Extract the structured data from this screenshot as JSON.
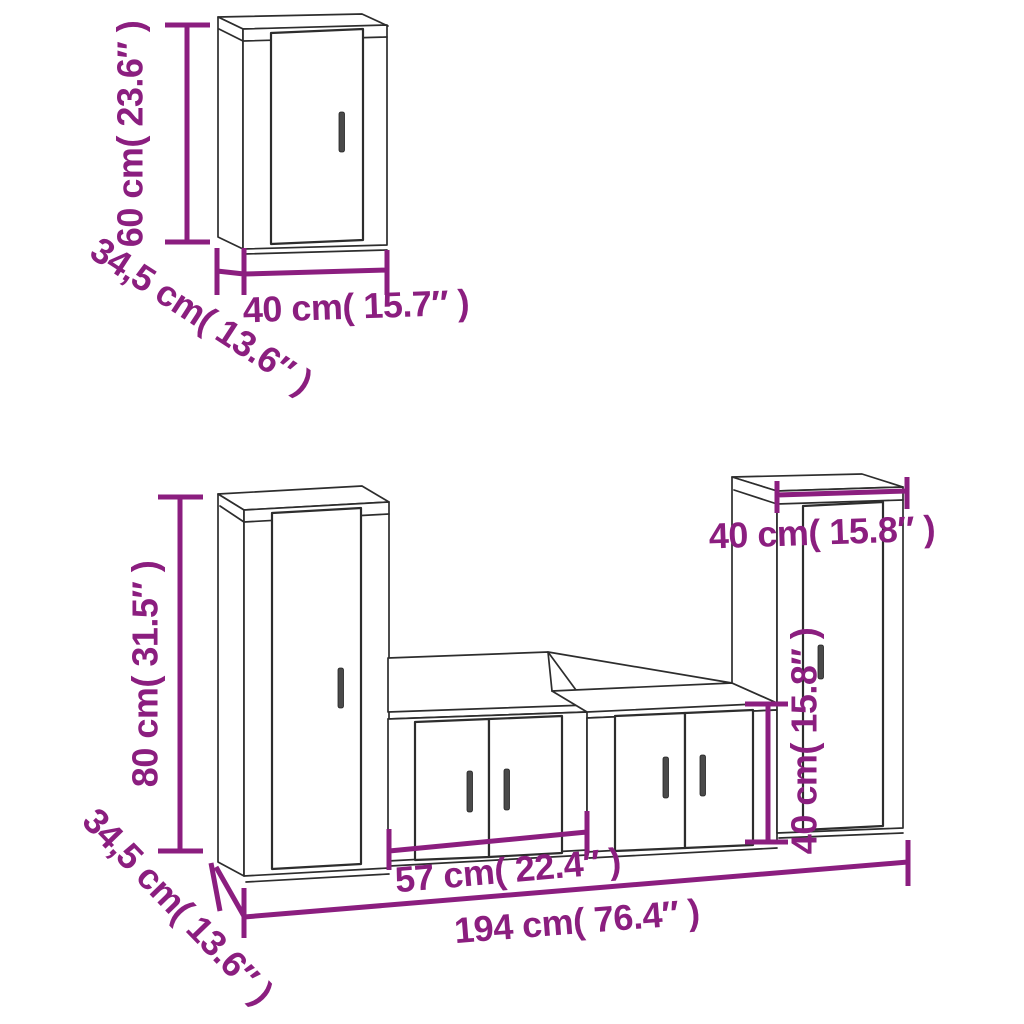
{
  "diagram": {
    "kind": "furniture-dimension-line-drawing",
    "subject": "5-piece TV wall cabinet set",
    "background_color": "#ffffff",
    "line_color": "#2d2d2d",
    "accent_color": "#8B1E7F",
    "top_cabinet": {
      "height_label": "60 cm( 23.6″ )",
      "depth_label": "34,5 cm( 13.6″ )",
      "width_label": "40 cm( 15.7″ )"
    },
    "bottom_group": {
      "tall_left_height_label": "80 cm( 31.5″ )",
      "depth_label": "34,5 cm( 13.6″ )",
      "low_cabinet_width_label": "57 cm( 22.4″ )",
      "total_width_label": "194 cm( 76.4″ )",
      "tall_right_width_label": "40 cm( 15.8″ )",
      "tall_right_height_label": "40 cm( 15.8″ )"
    }
  }
}
